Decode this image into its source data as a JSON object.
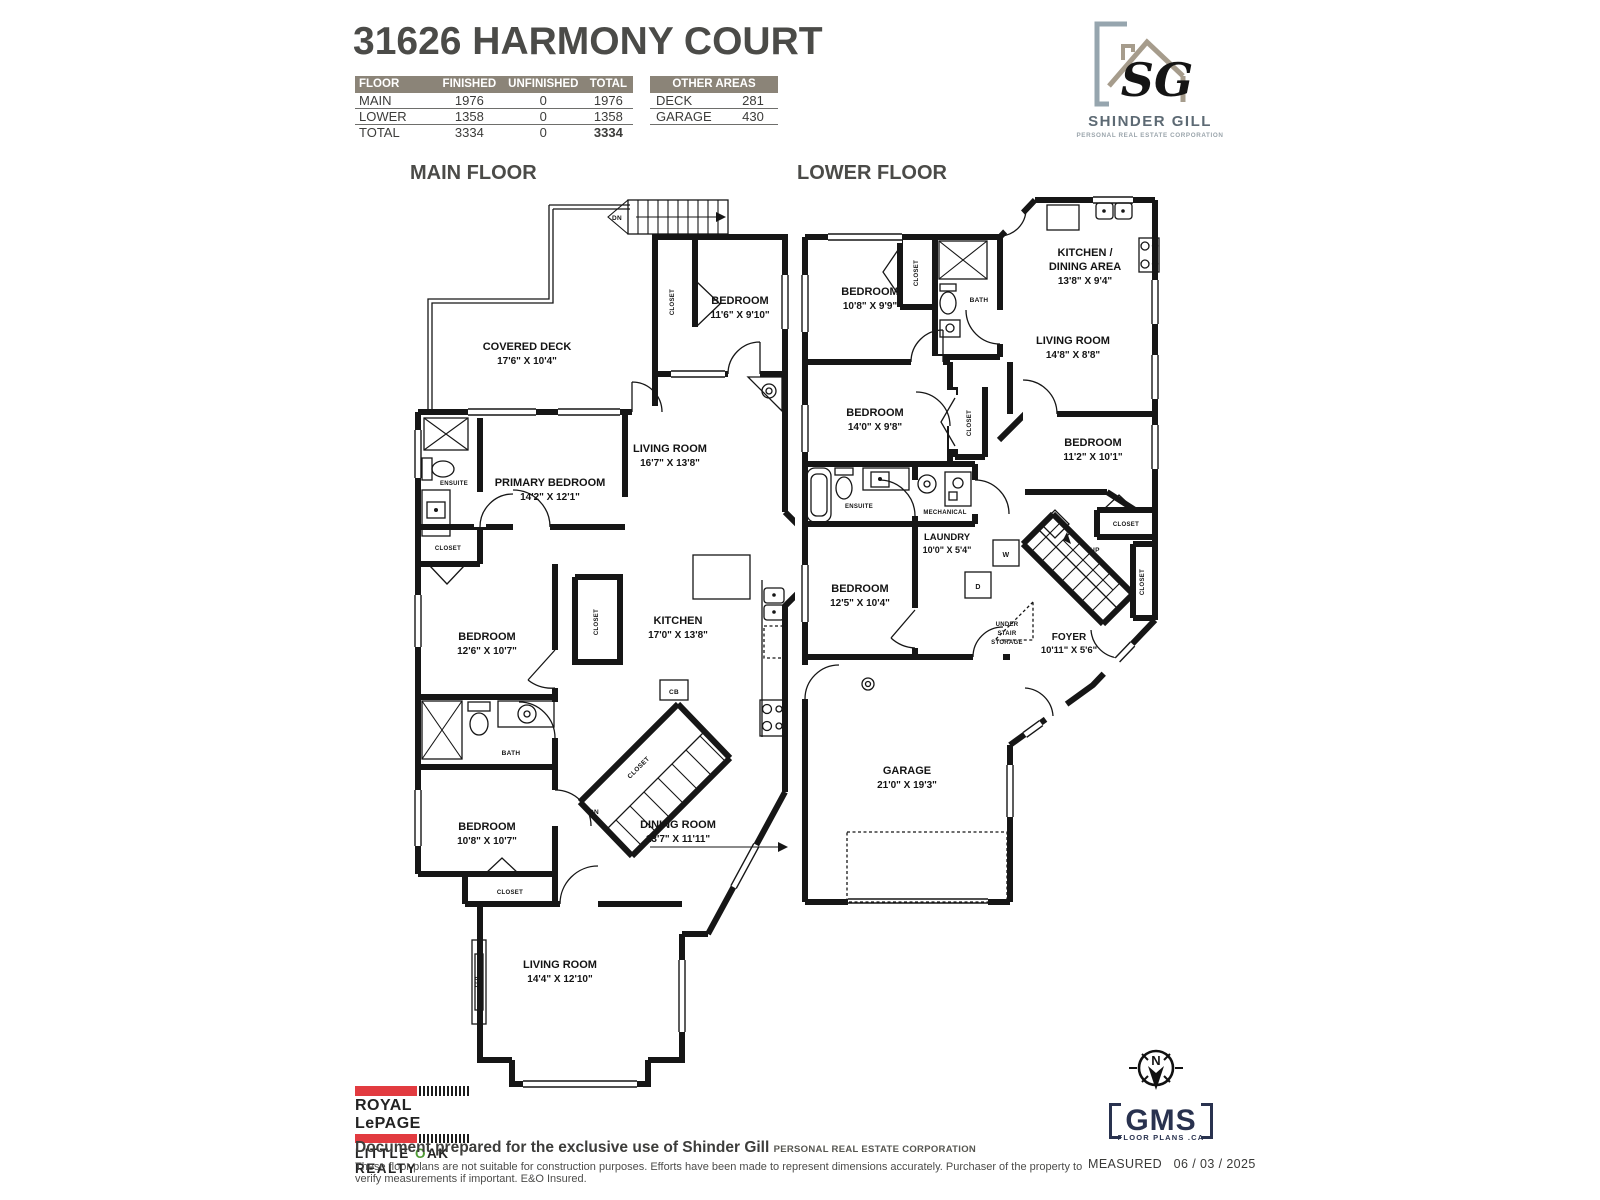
{
  "page": {
    "title": "31626 HARMONY COURT"
  },
  "colors": {
    "table_header_bg": "#8b8478",
    "royal_lepage_red": "#e23b40",
    "gms_navy": "#29324f",
    "logo_slate": "#96a5ae",
    "logo_taupe": "#a69c8c",
    "oak_green": "#4e9b34"
  },
  "area_table": {
    "headers": [
      "FLOOR",
      "FINISHED",
      "UNFINISHED",
      "TOTAL"
    ],
    "rows": [
      [
        "MAIN",
        "1976",
        "0",
        "1976"
      ],
      [
        "LOWER",
        "1358",
        "0",
        "1358"
      ],
      [
        "TOTAL",
        "3334",
        "0",
        "3334"
      ]
    ]
  },
  "other_areas": {
    "title": "OTHER AREAS",
    "rows": [
      [
        "DECK",
        "281"
      ],
      [
        "GARAGE",
        "430"
      ]
    ]
  },
  "brand": {
    "initials": "SG",
    "name": "SHINDER GILL",
    "tagline": "PERSONAL REAL ESTATE CORPORATION"
  },
  "main_floor": {
    "label": "MAIN FLOOR",
    "rooms": {
      "covered_deck": {
        "name": "COVERED DECK",
        "dims": "17'6\" X 10'4\""
      },
      "bedroom_top": {
        "name": "BEDROOM",
        "dims": "11'6\" X 9'10\""
      },
      "living_room": {
        "name": "LIVING ROOM",
        "dims": "16'7\" X 13'8\""
      },
      "primary_bedroom": {
        "name": "PRIMARY BEDROOM",
        "dims": "14'2\" X 12'1\""
      },
      "bedroom_mid": {
        "name": "BEDROOM",
        "dims": "12'6\" X 10'7\""
      },
      "kitchen": {
        "name": "KITCHEN",
        "dims": "17'0\" X 13'8\""
      },
      "bedroom_low": {
        "name": "BEDROOM",
        "dims": "10'8\" X 10'7\""
      },
      "dining_room": {
        "name": "DINING ROOM",
        "dims": "13'7\" X 11'11\""
      },
      "living_room_low": {
        "name": "LIVING ROOM",
        "dims": "14'4\" X 12'10\""
      }
    },
    "labels": {
      "ensuite": "ENSUITE",
      "bath": "BATH",
      "closet": "CLOSET",
      "dn": "DN",
      "cb": "CB",
      "efp": "EFP"
    }
  },
  "lower_floor": {
    "label": "LOWER FLOOR",
    "rooms": {
      "bedroom_a": {
        "name": "BEDROOM",
        "dims": "10'8\" X 9'9\""
      },
      "kitchen_dining": {
        "line1": "KITCHEN /",
        "line2": "DINING AREA",
        "dims": "13'8\" X 9'4\""
      },
      "living_room": {
        "name": "LIVING ROOM",
        "dims": "14'8\" X 8'8\""
      },
      "bedroom_b": {
        "name": "BEDROOM",
        "dims": "14'0\" X 9'8\""
      },
      "bedroom_c": {
        "name": "BEDROOM",
        "dims": "11'2\" X 10'1\""
      },
      "bedroom_d": {
        "name": "BEDROOM",
        "dims": "12'5\" X 10'4\""
      },
      "laundry": {
        "name": "LAUNDRY",
        "dims": "10'0\" X 5'4\""
      },
      "foyer": {
        "name": "FOYER",
        "dims": "10'11\" X 5'6\""
      },
      "garage": {
        "name": "GARAGE",
        "dims": "21'0\" X 19'3\""
      }
    },
    "labels": {
      "ensuite": "ENSUITE",
      "bath": "BATH",
      "closet": "CLOSET",
      "mechanical": "MECHANICAL",
      "laundry_w": "W",
      "laundry_d": "D",
      "up": "UP",
      "under_1": "UNDER",
      "under_2": "STAIR",
      "under_3": "STORAGE"
    }
  },
  "footer": {
    "brokerage_line1": "ROYAL LePAGE",
    "brokerage_line2_pre": "LITTLE ",
    "brokerage_line2_o": "O",
    "brokerage_line2_post": "AK REALTY",
    "prepared": "Document prepared for the exclusive use of Shinder Gill ",
    "prepared_suffix": "PERSONAL REAL ESTATE CORPORATION",
    "disclaimer": "These floor plans are not suitable for construction purposes. Efforts have been made to represent dimensions accurately.  Purchaser of the property to verify measurements if important.  E&O Insured.",
    "measured_label": "MEASURED",
    "measured_date": "06 / 03 / 2025",
    "gms_name": "GMS",
    "gms_sub": "FLOOR PLANS .CA",
    "compass_n": "N"
  }
}
